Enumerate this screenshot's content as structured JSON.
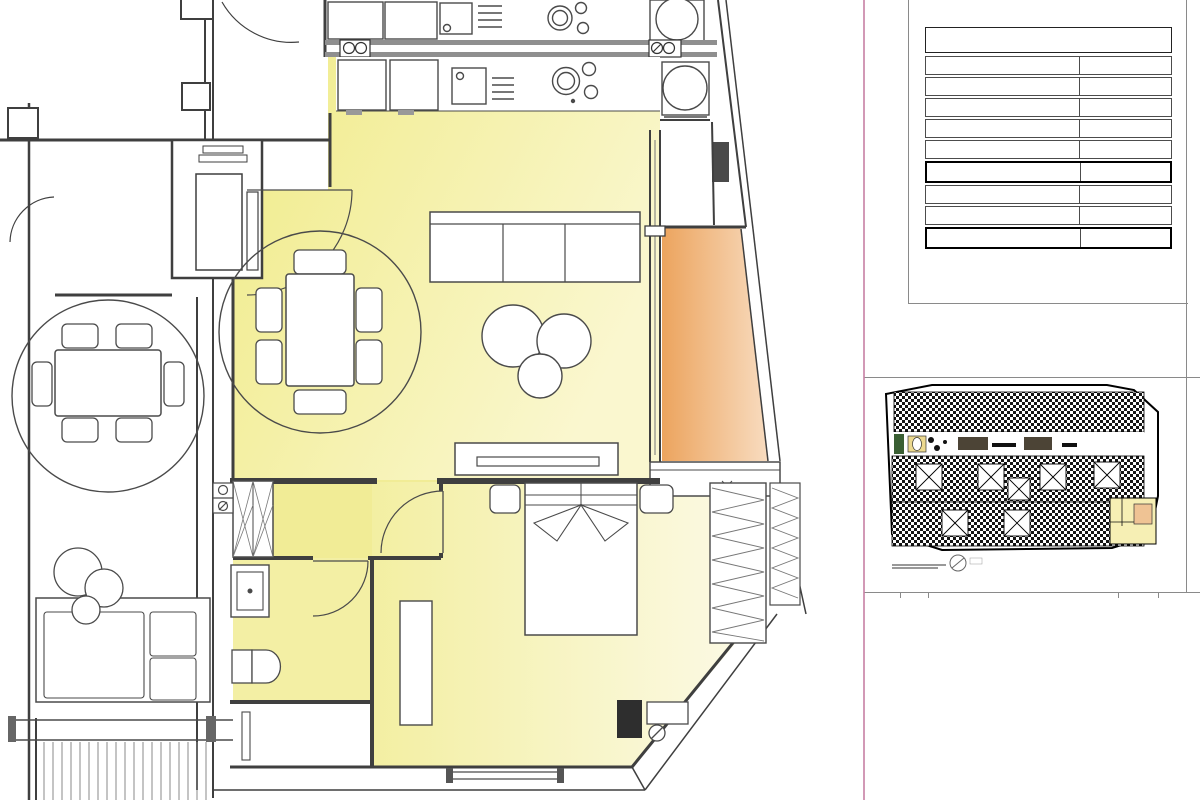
{
  "colors": {
    "room_fill": "#f2ee9a",
    "terrace_fill": "#efae6d",
    "pink_line": "#c77fa4",
    "wall": "#3f3f3f"
  },
  "floor_plan": {
    "stairwell": {
      "name": "ESCALERA 3",
      "area": "22.36 M2"
    },
    "grid_refs": {
      "h": "H",
      "i": "I",
      "j": "J"
    },
    "neighbor_label_fragment": "INA",
    "rooms": {
      "living": {
        "name": "COM-ESTAR-COCINA",
        "area": "27.82 M2"
      },
      "hall": {
        "name": "PASO",
        "area": "1.62 M2"
      },
      "bathroom": {
        "name": "BAÑO",
        "area": "4.68 M2"
      },
      "bedroom": {
        "name": "DORM.1",
        "area": "15.00 M2"
      },
      "terrace": {
        "name": "TERRAZA",
        "area": "3.48 M2"
      },
      "lower_terrace": {
        "name": "TERRAZA",
        "area": "4.72 M2"
      }
    },
    "appliances": {
      "micro_fridge": "micro/frigo",
      "oven_line1": "horno/",
      "oven_line2": "congelador",
      "boiler_line1": "Termo/",
      "boiler_line2": "Lavadora"
    },
    "watermark": {
      "main": "C☀STABLANCA",
      "sub": "estate"
    }
  },
  "info_sheet": {
    "title": "APPARTMENT 1-3-I",
    "rows": [
      {
        "label": "Salon- Kitchen",
        "value": "27,82 m²"
      },
      {
        "label": "Circulation",
        "value": "1,62 m²"
      },
      {
        "label": "Bedroom 1",
        "value": "15,00 m²"
      },
      {
        "label": "Bathroom 1",
        "value": "4,68 m²"
      },
      {
        "label": "Tot. Surface Int.",
        "value": "49,12 m²"
      },
      {
        "label": "Terrace",
        "value": "3,48 m²"
      },
      {
        "label": "Tot. Surface",
        "value": "52,60 m²"
      }
    ]
  },
  "key_plan": {
    "caption": "PLANTA PRIMERA"
  }
}
